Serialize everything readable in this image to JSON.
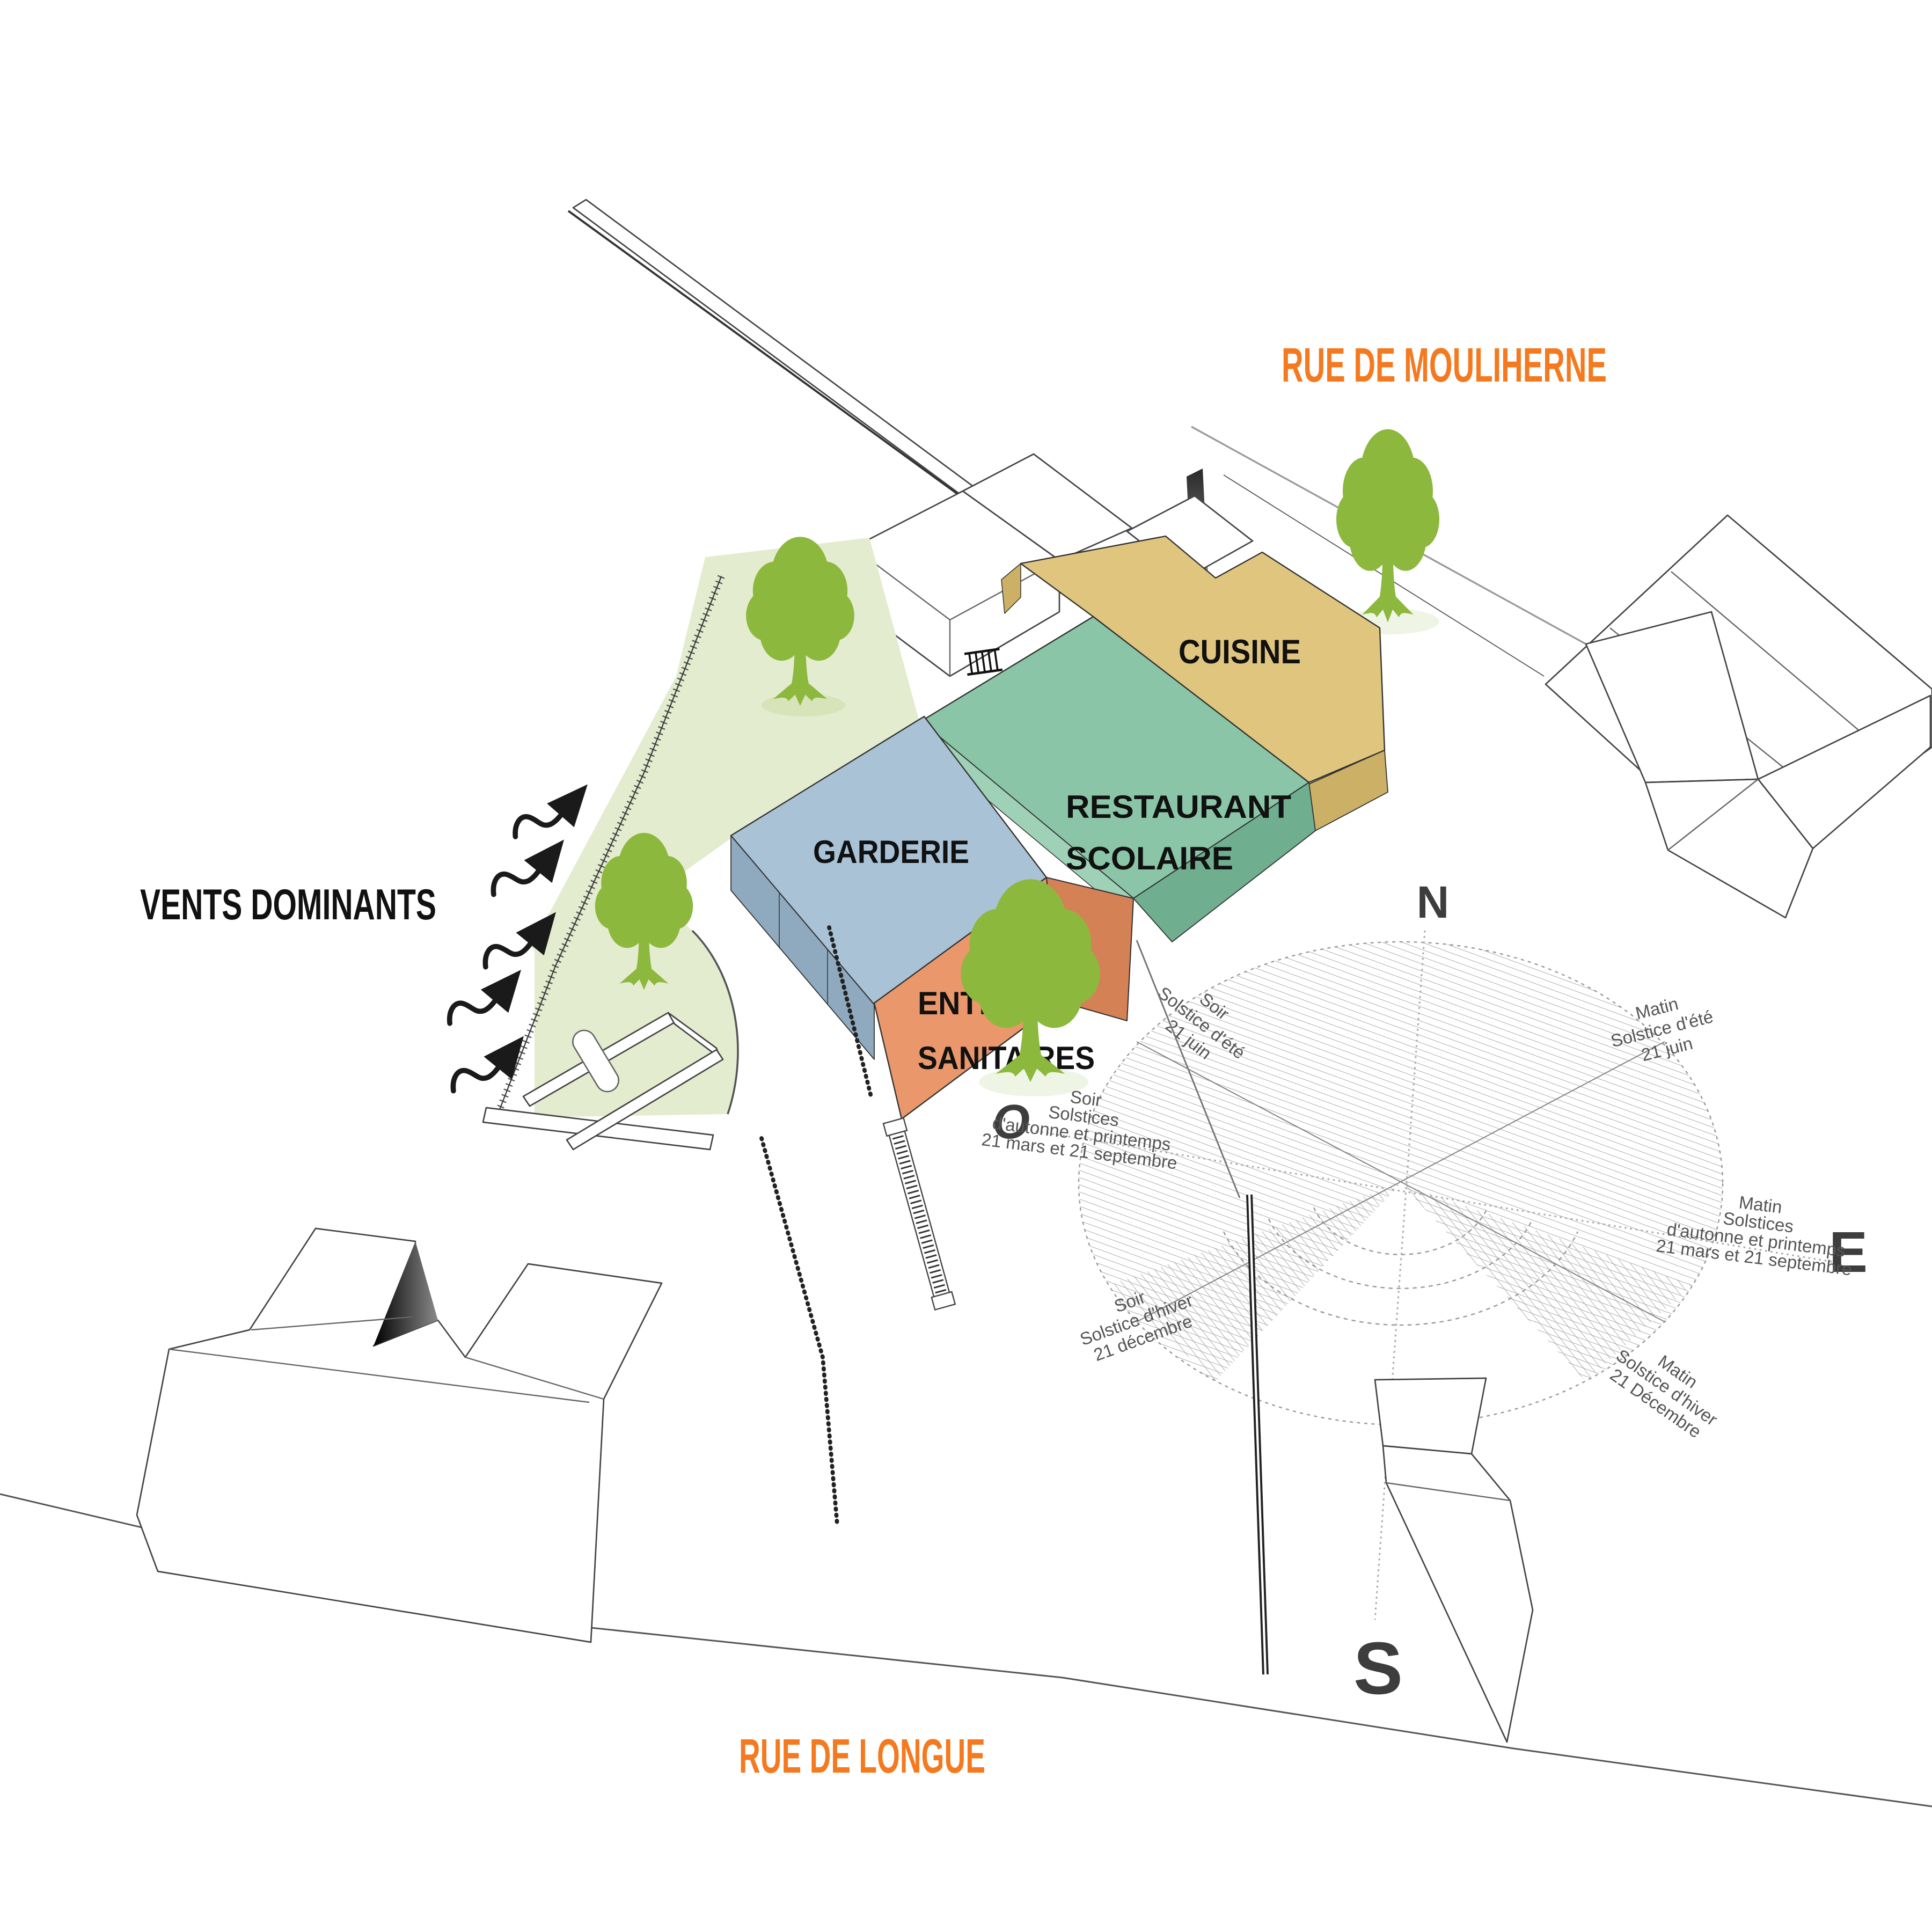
{
  "title": "Site diagram - school restaurant",
  "colors": {
    "street_label": "#F4791F",
    "cuisine": "#DFC57E",
    "cuisine_side": "#CBB065",
    "restaurant": "#8AC5A7",
    "restaurant_side": "#6FAE8F",
    "restaurant_ledge": "#9ED1B6",
    "garderie": "#A9C2D5",
    "garderie_side": "#8FA9BE",
    "entree": "#E9976B",
    "entree_side": "#D58156",
    "lawn": "#E3ECCE",
    "tree": "#8CB83D",
    "ink": "#111111"
  },
  "streets": {
    "top": "RUE DE MOULIHERNE",
    "bottom": "RUE DE LONGUE"
  },
  "wind": {
    "label": "VENTS DOMINANTS"
  },
  "buildings": {
    "cuisine": "CUISINE",
    "restaurant_line1": "RESTAURANT",
    "restaurant_line2": "SCOLAIRE",
    "garderie": "GARDERIE",
    "entree_line1": "ENTREE /",
    "entree_line2": "SANITAIRES"
  },
  "compass": {
    "north": "N",
    "south": "S",
    "east": "E",
    "west": "O"
  },
  "sun_labels": {
    "soir_ete": {
      "l1": "Soir",
      "l2": "Solstice d'été",
      "l3": "21 juin"
    },
    "matin_ete": {
      "l1": "Matin",
      "l2": "Solstice d'été",
      "l3": "21 juin"
    },
    "soir_equinoxe": {
      "l1": "Soir",
      "l2": "Solstices",
      "l3": "d'autonne et printemps",
      "l4": "21 mars et 21 septembre"
    },
    "matin_equinoxe": {
      "l1": "Matin",
      "l2": "Solstices",
      "l3": "d'autonne et printemps",
      "l4": "21 mars et 21 septembre"
    },
    "soir_hiver": {
      "l1": "Soir",
      "l2": "Solstice d'hiver",
      "l3": "21 décembre"
    },
    "matin_hiver": {
      "l1": "Matin",
      "l2": "Solstice d'hiver",
      "l3": "21 Décembre"
    }
  }
}
